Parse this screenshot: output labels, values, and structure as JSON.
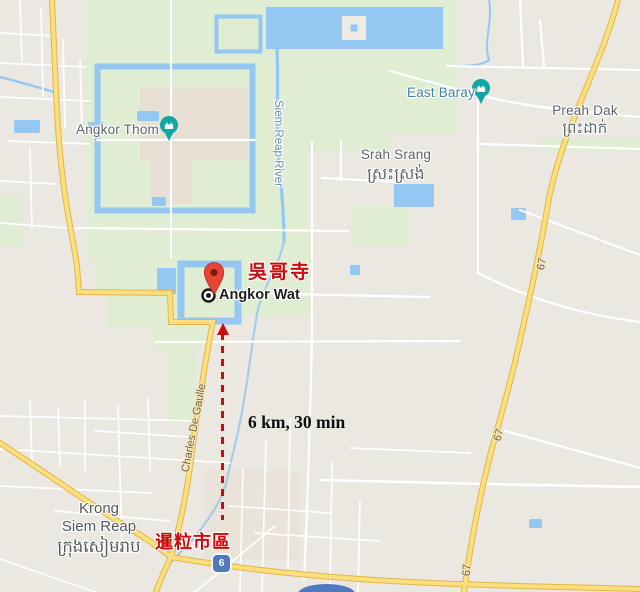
{
  "places": {
    "angkor_thom": "Angkor Thom",
    "angkor_wat": "Angkor Wat",
    "east_baray": "East Baray",
    "preah_dak": "Preah Dak",
    "preah_dak_km": "ព្រះដាក់",
    "srah_srang": "Srah Srang",
    "srah_srang_km": "ស្រះស្រង់",
    "krong_1": "Krong",
    "krong_2": "Siem Reap",
    "krong_km": "ក្រុងសៀមរាប"
  },
  "roads": {
    "siem_reap_river": "Siem Reap River",
    "charles_de_gaulle": "Charles De Gaulle",
    "route_67": "67",
    "route_6": "6"
  },
  "annotations": {
    "angkor_wat_cn": "吳哥寺",
    "siem_reap_city_cn": "暹粒市區",
    "route_info": "6 km, 30 min"
  },
  "colors": {
    "water": "#95C7F3",
    "park_green": "#DFEDD2",
    "urban_gray": "#EBE8E1",
    "highway_yellow": "#FBDF7D",
    "poi_teal": "#11A5A3",
    "pin_red": "#E94335",
    "shield_blue": "#4E79BE",
    "annotation_red": "#CC0B0B"
  }
}
